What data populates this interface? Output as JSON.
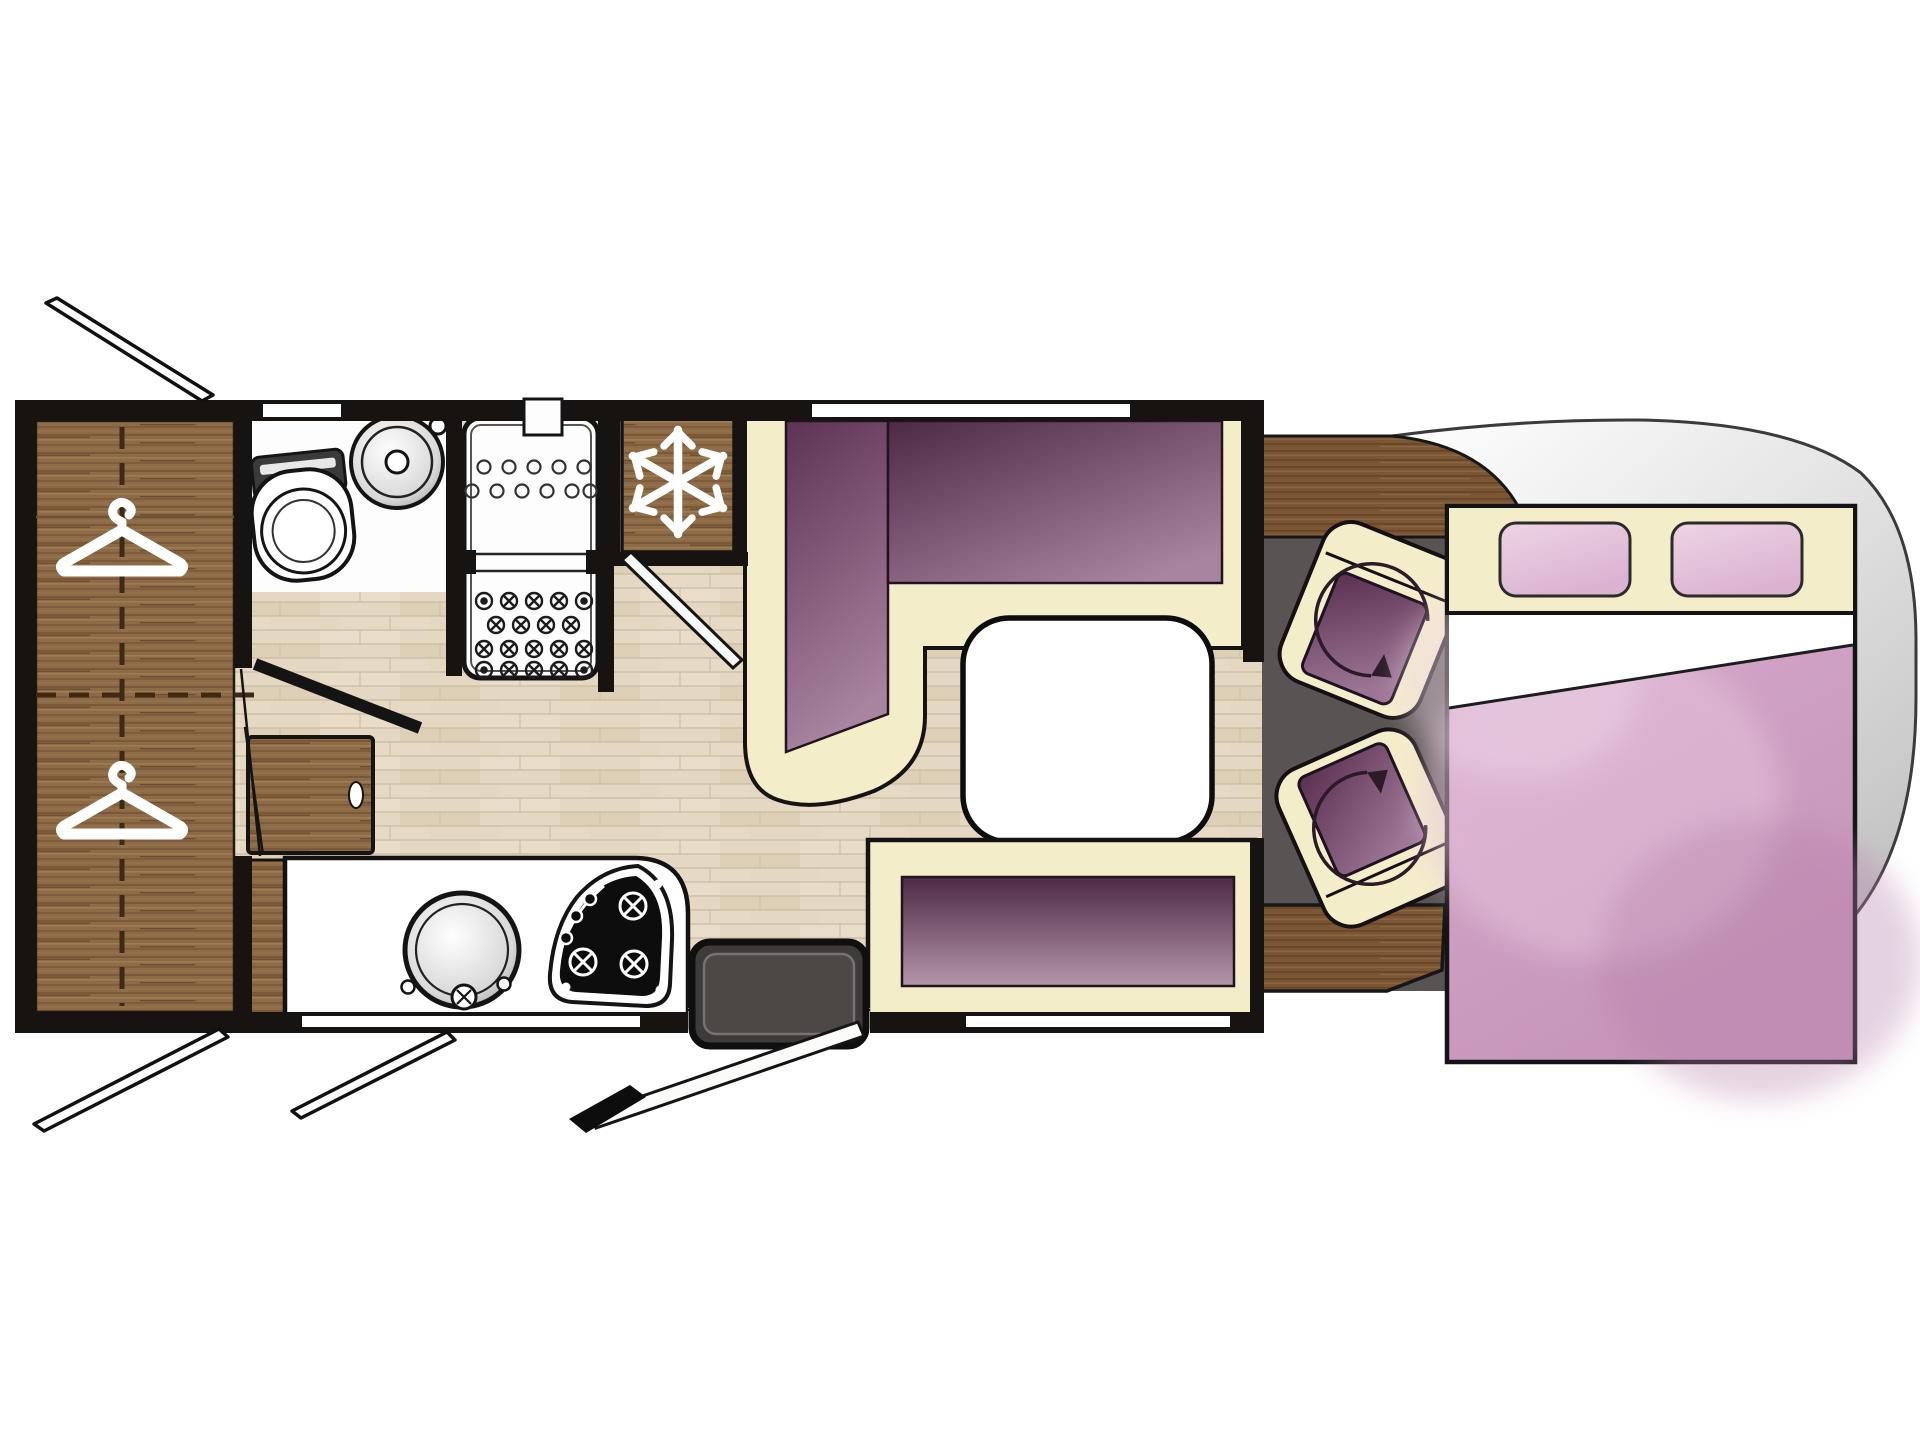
{
  "meta": {
    "type": "floorplan",
    "subject": "motorhome-layout-top-view",
    "orientation": "cab-at-right"
  },
  "palette": {
    "wall": "#171310",
    "outline": "#141414",
    "floor": "#e4d8c2",
    "floor_line": "#cfc0a6",
    "wood": "#8d6b46",
    "wood_stripe": "#7a583a",
    "wood_hi": "#9e7c52",
    "wood_dark": "#7b5634",
    "wood_dark_stripe": "#694628",
    "cream": "#f4edca",
    "purple_dark": "#4e2944",
    "purple_deep": "#5d3253",
    "purple_light": "#a884a0",
    "purple_pale": "#b497ab",
    "bed_pink": "#d9aecf",
    "bed_pink_deep": "#c795ba",
    "bed_pink_light": "#ecd4e4",
    "cab_floor": "#585453",
    "shell_light": "#ffffff",
    "shell_gray": "#c2c2c2",
    "step_gray": "#4b4846",
    "white": "#ffffff"
  },
  "areas": {
    "wardrobe": {
      "label": "wardrobe",
      "icons": [
        "hanger-icon",
        "hanger-icon"
      ]
    },
    "washroom": {
      "label": "washroom",
      "fixtures": [
        "toilet",
        "round-basin",
        "hinged-door"
      ]
    },
    "shower": {
      "label": "shower-cabin",
      "features": [
        "drain-grid",
        "folding-door"
      ]
    },
    "refrigerator": {
      "label": "refrigerator",
      "icon": "snowflake-icon"
    },
    "hall": {
      "label": "hallway",
      "furniture": [
        "side-desk"
      ]
    },
    "kitchen": {
      "label": "kitchenette",
      "fixtures": [
        "round-sink",
        "three-burner-hob"
      ]
    },
    "dinette": {
      "label": "l-shaped-dinette",
      "furniture": [
        "l-seat",
        "dining-table",
        "side-bench"
      ]
    },
    "entrance": {
      "label": "entrance",
      "features": [
        "entry-step",
        "open-door-leaf"
      ]
    },
    "cab": {
      "label": "driver-cab",
      "furniture": [
        "dashboard",
        "swivel-seat",
        "swivel-seat",
        "floor-platform"
      ],
      "icons": [
        "rotate-arrow-icon",
        "rotate-arrow-icon"
      ]
    },
    "bedroom": {
      "label": "drop-down-double-bed",
      "features": [
        "headboard",
        "pillow",
        "pillow",
        "folded-sheet"
      ]
    }
  },
  "exterior": {
    "openings": [
      "roof-flap-top-left",
      "roof-flap-bottom-left",
      "roof-flap-bottom-center",
      "entry-door-swing"
    ]
  }
}
